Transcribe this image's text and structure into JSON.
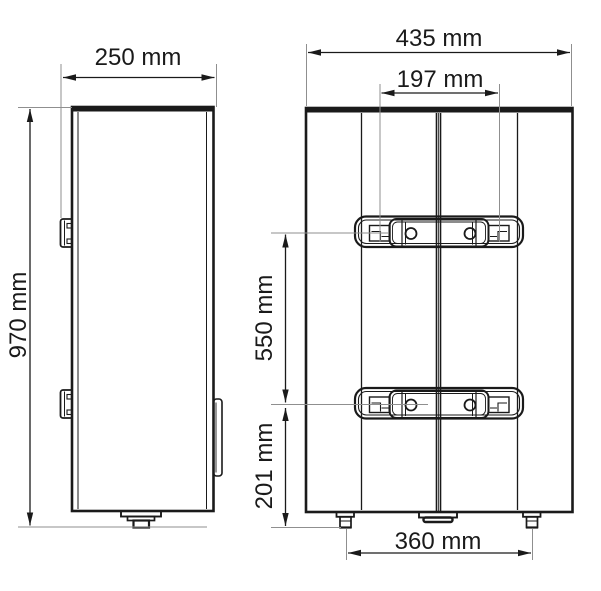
{
  "colors": {
    "drawing_line": "#1a1a1a",
    "extension_line": "#8f8f8f",
    "background": "#ffffff"
  },
  "diagram": {
    "type": "technical dimensional drawing",
    "subject": "wall-mounted water heater, side view and back view",
    "views": {
      "side": {
        "name": "side-view",
        "dimensions": {
          "width": "250 mm",
          "height": "970 mm"
        }
      },
      "back": {
        "name": "back-view",
        "dimensions": {
          "width": "435 mm",
          "bracket_slot_spacing": "197 mm",
          "bracket_row_spacing": "550 mm",
          "lower_bracket_to_bottom": "201 mm",
          "feet_spacing": "360 mm"
        }
      }
    }
  }
}
